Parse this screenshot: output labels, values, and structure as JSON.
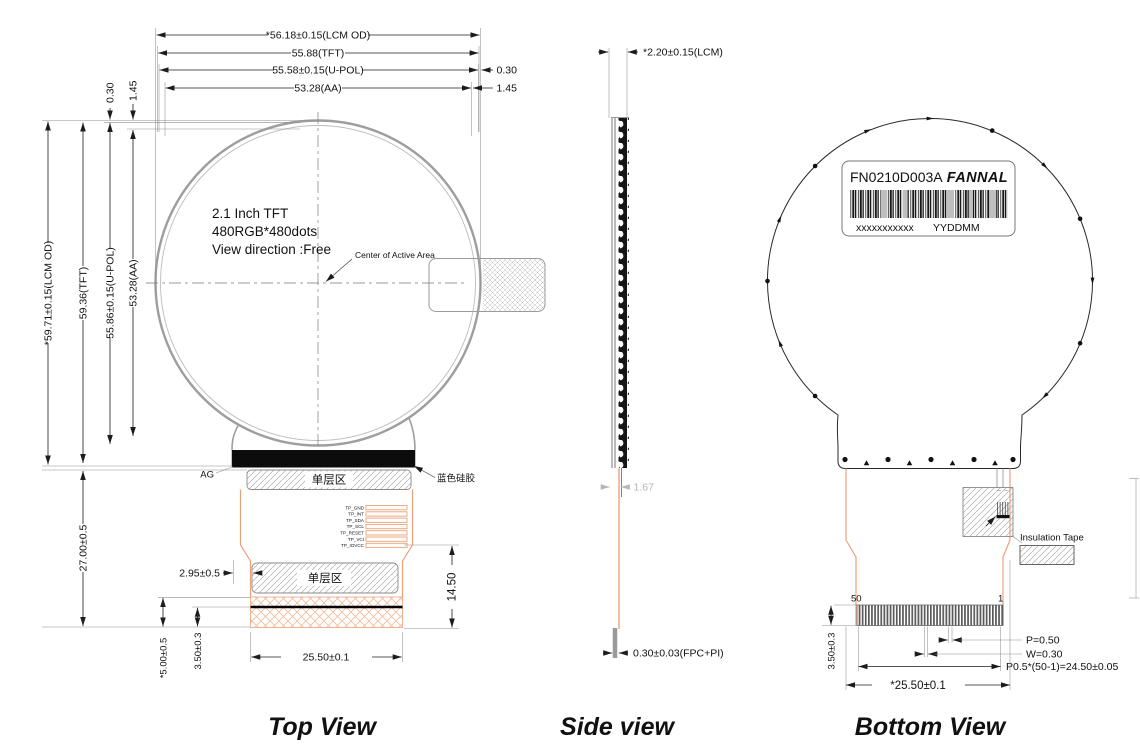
{
  "colors": {
    "fpc_orange": "#eba27b",
    "outline_gray": "#9e9e9e",
    "hatch_orange": "#f2bb9b",
    "dim_gray": "#b5b5b5"
  },
  "titles": {
    "top": "Top View",
    "side": "Side view",
    "bottom": "Bottom View"
  },
  "top_view": {
    "dims_width": [
      "*56.18±0.15(LCM OD)",
      "55.88(TFT)",
      "55.58±0.15(U-POL)",
      "53.28(AA)"
    ],
    "gap_right": [
      "0.30",
      "1.45"
    ],
    "gap_top_left": [
      "0.30",
      "1.45"
    ],
    "dims_height": [
      "*59.71±0.15(LCM OD)",
      "59.36(TFT)",
      "55.86±0.15(U-POL)",
      "53.28(AA)"
    ],
    "dim_tail_height": "27.00±0.5",
    "panel_line1": "2.1 Inch TFT",
    "panel_line2": "480RGB*480dots",
    "panel_line3": "View direction :Free",
    "center_label": "Center of Active Area",
    "ag_label": "AG",
    "single_layer_1": "单层区",
    "silicone_label": "蓝色硅胶",
    "pins": [
      "TP_GND",
      "TP_INT",
      "TP_SDA",
      "TP_SCL",
      "TP_RESET",
      "TP_VCI",
      "TP_IOVCC"
    ],
    "dim_offset_left": "2.95±0.5",
    "single_layer_2": "单层区",
    "dim_tail_right": "14.50",
    "dim_fpc_width": "25.50±0.1",
    "dim_stiffener_1": "3.50±0.3",
    "dim_stiffener_2": "*5.00±0.5"
  },
  "side_view": {
    "dim_thickness": "*2.20±0.15(LCM)",
    "dim_offset": "1.67",
    "dim_fpc": "0.30±0.03(FPC+PI)"
  },
  "bottom_view": {
    "label_model": "FN0210D003A",
    "label_brand": "FANNAL",
    "label_serial": "xxxxxxxxxxx",
    "label_date": "YYDDMM",
    "insulation_label": "Insulation Tape",
    "pin_left": "50",
    "pin_right": "1",
    "dim_pitch": "P=0.50",
    "dim_finger_width": "W=0.30",
    "dim_total_pitch": "P0.5*(50-1)=24.50±0.05",
    "dim_fpc_width": "*25.50±0.1",
    "dim_connector_height": "3.50±0.3"
  }
}
